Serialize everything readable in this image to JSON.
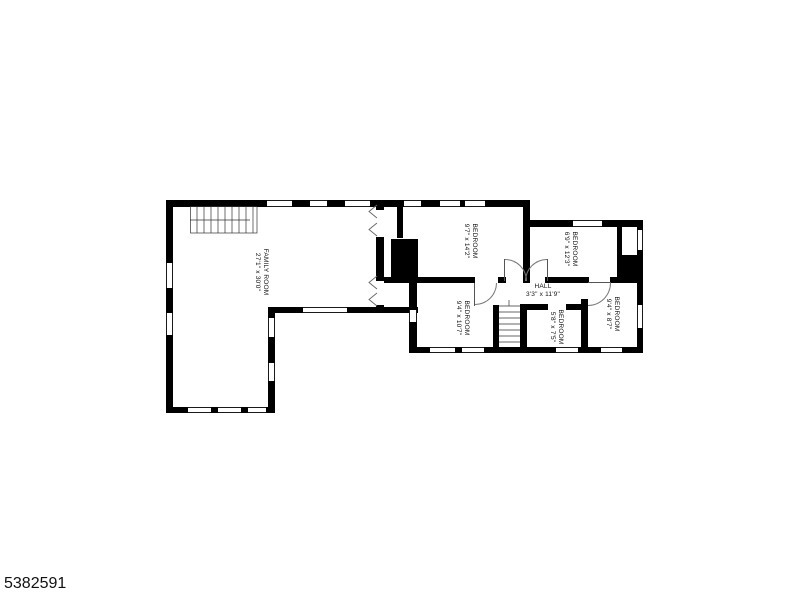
{
  "photo_id": "5382591",
  "rooms": {
    "family_room": {
      "name": "FAMILY ROOM",
      "dims": "27'1\" x 30'0\""
    },
    "bedroom_top_middle": {
      "name": "BEDROOM",
      "dims": "9'7\" x 14'2\""
    },
    "bedroom_top_right": {
      "name": "BEDROOM",
      "dims": "6'9\" x 12'3\""
    },
    "hall": {
      "name": "HALL",
      "dims": "3'3\" x 11'9\""
    },
    "bedroom_bottom_left": {
      "name": "BEDROOM",
      "dims": "9'4\" x 10'7\""
    },
    "bedroom_bottom_middle": {
      "name": "BEDROOM",
      "dims": "5'8\" x 7'5\""
    },
    "bedroom_bottom_right": {
      "name": "BEDROOM",
      "dims": "9'4\" x 8'7\""
    }
  },
  "colors": {
    "wall": "#000000",
    "line": "#555555",
    "background": "#ffffff"
  }
}
